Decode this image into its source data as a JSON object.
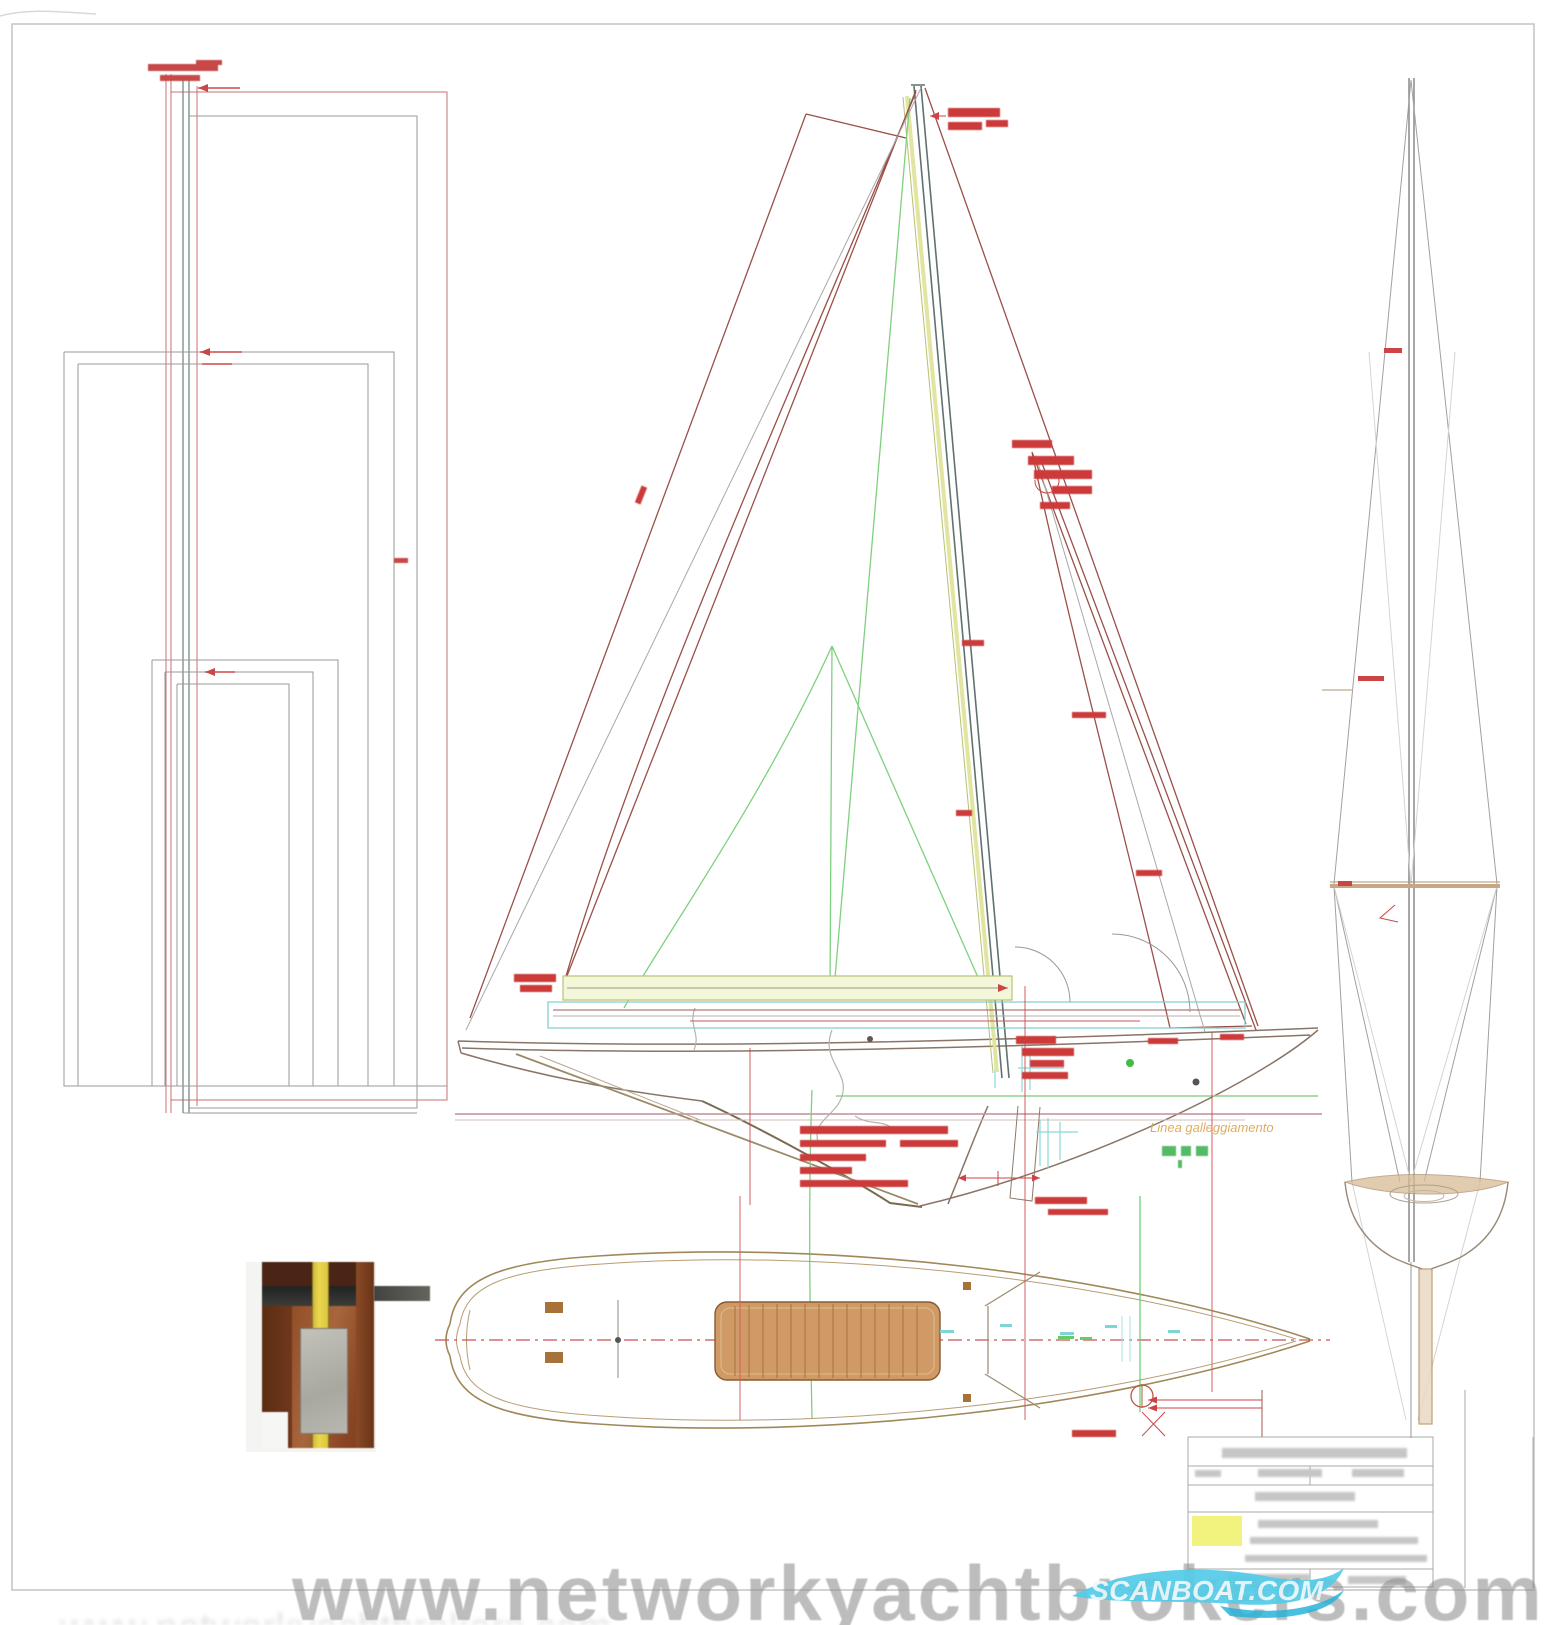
{
  "document": {
    "kind": "sailing-yacht technical drawing (sail plan, mast views, deck plan)",
    "watermark": "www.networkyachtbrokers.com",
    "logo_text": "SCANBOAT.COM",
    "labels": {
      "waterline": "Linea galleggiamento"
    },
    "colors": {
      "paper": "#ffffff",
      "dimension_red": "#cc4444",
      "sail_outline_maroon": "#9a5048",
      "rig_gray": "#a0a0a0",
      "spar_yellow": "#f4f6da",
      "detail_teal": "#84cfcf",
      "rigging_green": "#7ed07e",
      "deck_tan": "#a08858",
      "cabin_brown": "#cf9a66",
      "waterline_orange": "#dca450",
      "watermark_gray": "#8e8e8e",
      "logo_cyan": "#54cbe8",
      "highlight_yellow": "#f0f068"
    }
  }
}
